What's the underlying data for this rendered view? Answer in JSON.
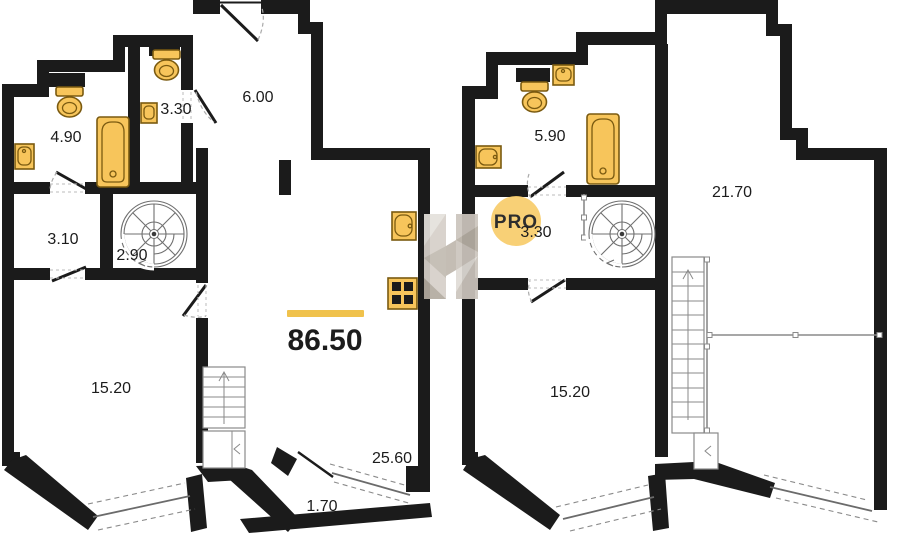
{
  "watermark": {
    "letter": "H",
    "badge": "PRO"
  },
  "colors": {
    "wall": "#1b1b1b",
    "fixture_fill": "#F7C55B",
    "accent": "#F0C24C",
    "watermark_badge": "#F8CD6B",
    "watermark_text": "#8E8C85"
  },
  "plans": {
    "level1": {
      "total_area": "86.50",
      "rooms": {
        "bathroom": "4.90",
        "wc": "3.30",
        "entry_hall": "6.00",
        "corridor": "3.10",
        "stairwell": "2.90",
        "bedroom": "15.20",
        "terrace": "25.60",
        "balcony": "1.70"
      }
    },
    "level2": {
      "rooms": {
        "bathroom": "5.90",
        "hallway": "3.30",
        "living_room": "21.70",
        "bedroom": "15.20"
      }
    }
  }
}
